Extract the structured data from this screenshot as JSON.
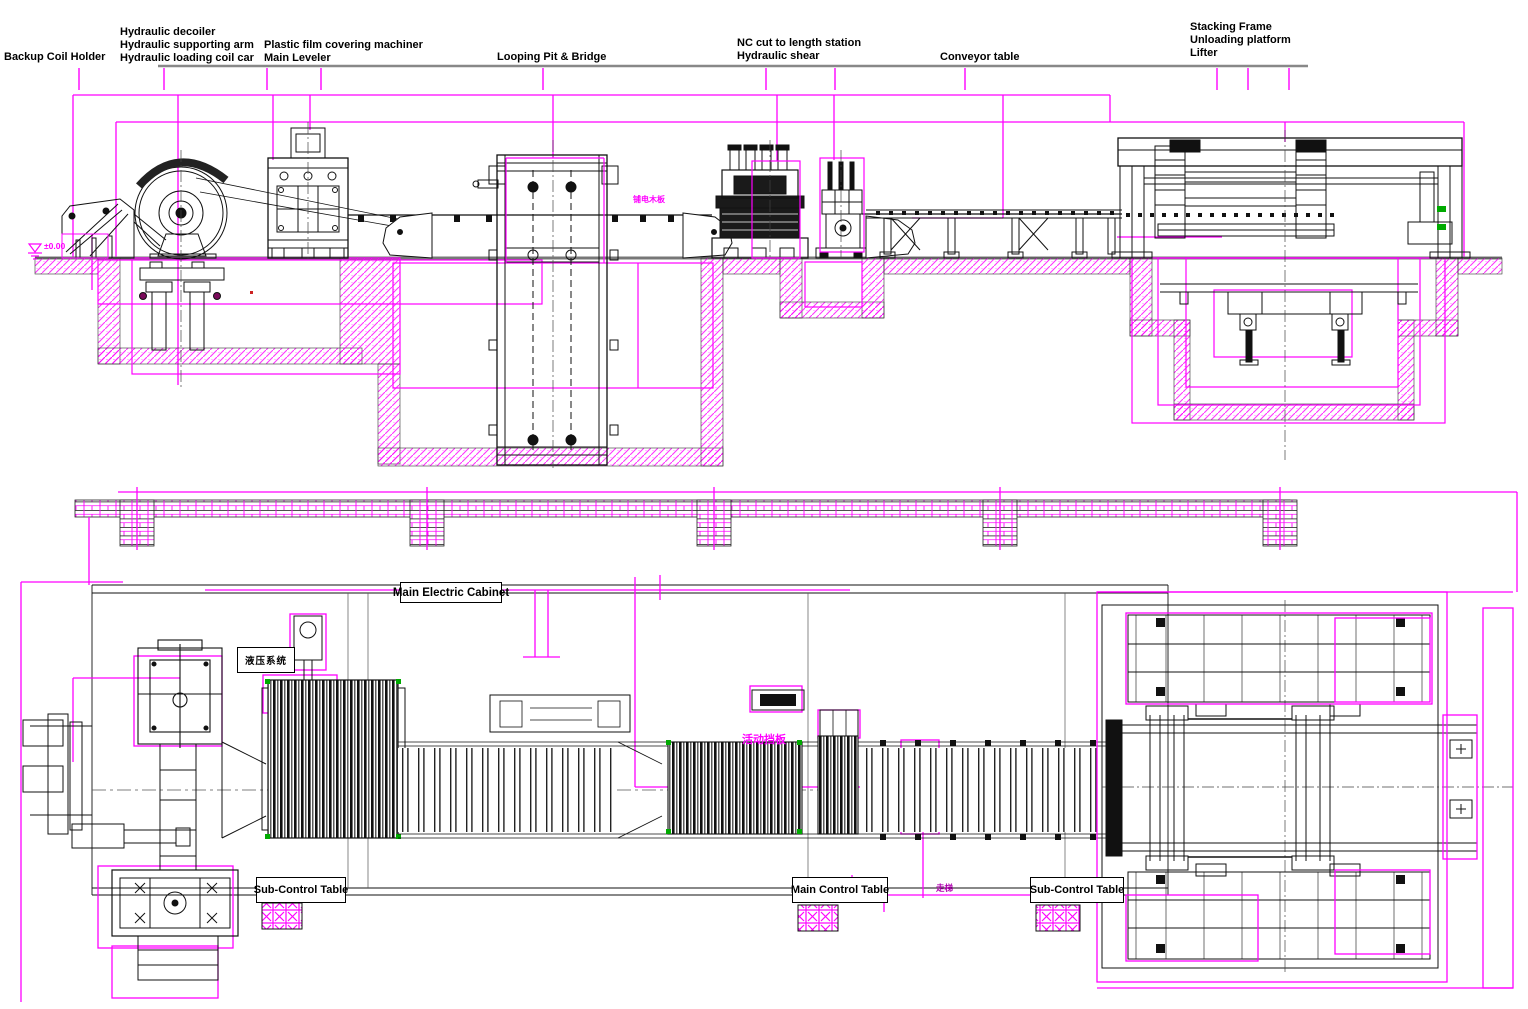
{
  "labels": {
    "backup": "Backup Coil Holder",
    "decoiler_1": "Hydraulic decoiler",
    "decoiler_2": "Hydraulic supporting arm",
    "decoiler_3": "Hydraulic loading coil car",
    "film_1": "Plastic film covering machiner",
    "film_2": "Main Leveler",
    "looping": "Looping Pit & Bridge",
    "shear_1": "NC cut to length station",
    "shear_2": "Hydraulic shear",
    "conveyor": "Conveyor table",
    "stacking_1": "Stacking Frame",
    "stacking_2": "Unloading platform",
    "stacking_3": "Lifter"
  },
  "plan": {
    "main_electric_cabinet": "Main Electric Cabinet",
    "hydraulic_system": "液压系统",
    "sub_control_left": "Sub-Control Table",
    "main_control": "Main Control Table",
    "sub_control_right": "Sub-Control Table"
  },
  "annotations": {
    "level_mark": "±0.00",
    "strip_note": "铺电木板",
    "guard_note": "活动挡板",
    "ladder_note": "走梯"
  },
  "colors": {
    "line_black": "#000000",
    "accent_magenta": "#FF00FF",
    "ground_gray": "#808080",
    "detail_green": "#00A000",
    "marker_red": "#CC2200"
  }
}
